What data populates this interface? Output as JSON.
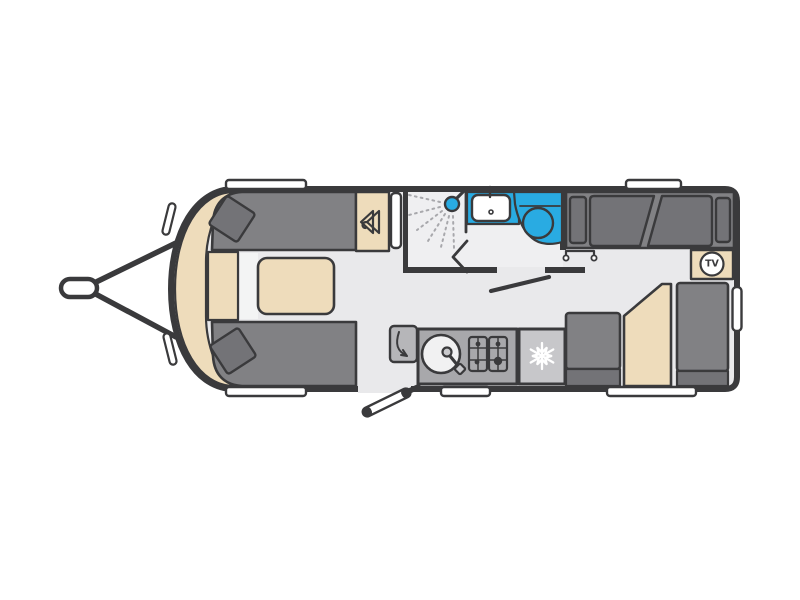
{
  "floorplan": {
    "tv_label": "TV",
    "colors": {
      "page": "#ffffff",
      "wall": "#3a3a3c",
      "floor": "#e9e9eb",
      "washroom": "#efeff1",
      "sofa": "#818184",
      "cushion": "#737377",
      "wood": "#eedcbb",
      "water": "#29abe2",
      "counter": "#a8a8ab",
      "flap": "#b6b6b9",
      "appliance": "#c7c7ca",
      "white": "#ffffff",
      "sinkwhite": "#f1f1f2",
      "metal": "#c9c9cc",
      "spray": "#a8a8ac",
      "strip": "#f3f4f4"
    },
    "icons": {
      "tow-hitch-icon": "caravan A-frame tow hitch",
      "hanger-icon": "coat hanger (wardrobe)",
      "shower-head-icon": "shower head with spray jets",
      "basin-icon": "washroom basin with tap",
      "toilet-icon": "toilet bowl",
      "door-swing-icon": "open washroom door",
      "flap-arrow-icon": "worktop flap swing arrow",
      "sink-icon": "round kitchen sink",
      "tap-lever-icon": "kitchen mixer tap",
      "hob-icon": "gas hob burners",
      "snowflake-icon": "fridge freezer",
      "tv-badge": "TV point",
      "entrance-door-icon": "open entrance door leaf"
    }
  }
}
